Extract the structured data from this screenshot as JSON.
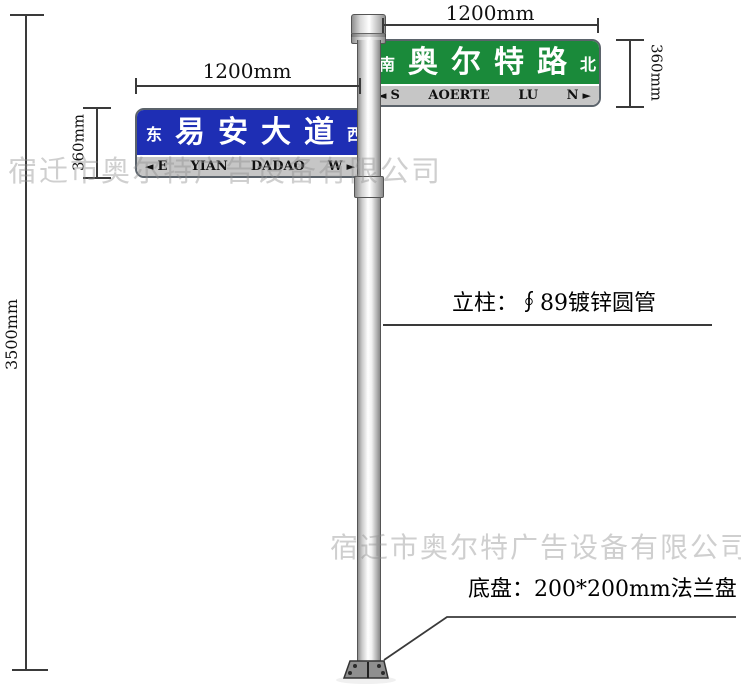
{
  "colors": {
    "sign_green": "#1a8a3a",
    "sign_blue": "#1e2eb4",
    "strip_gray": "#c6c6c6",
    "line_color": "#3a3a3a",
    "flange_gray": "#8f8f8f",
    "watermark_gray": "#bfbfbf"
  },
  "dims": {
    "total_height": "3500mm",
    "green_sign_width": "1200mm",
    "green_sign_height": "360mm",
    "blue_sign_width": "1200mm",
    "blue_sign_height": "360mm"
  },
  "annotations": {
    "pole_spec": "立柱：∮89镀锌圆管",
    "base_spec": "底盘：200*200mm法兰盘"
  },
  "green_sign": {
    "direction_left": "南",
    "name": "奥尔特路",
    "direction_right": "北",
    "strip": {
      "left_arrow": "◄",
      "left_label": "S",
      "word1": "AOERTE",
      "word2": "LU",
      "right_label": "N",
      "right_arrow": "►"
    }
  },
  "blue_sign": {
    "direction_left": "东",
    "name": "易安大道",
    "direction_right": "西",
    "strip": {
      "left_arrow": "◄",
      "left_label": "E",
      "word1": "YIAN",
      "word2": "DADAO",
      "right_label": "W",
      "right_arrow": "►"
    }
  },
  "watermark": "宿迁市奥尔特广告设备有限公司"
}
